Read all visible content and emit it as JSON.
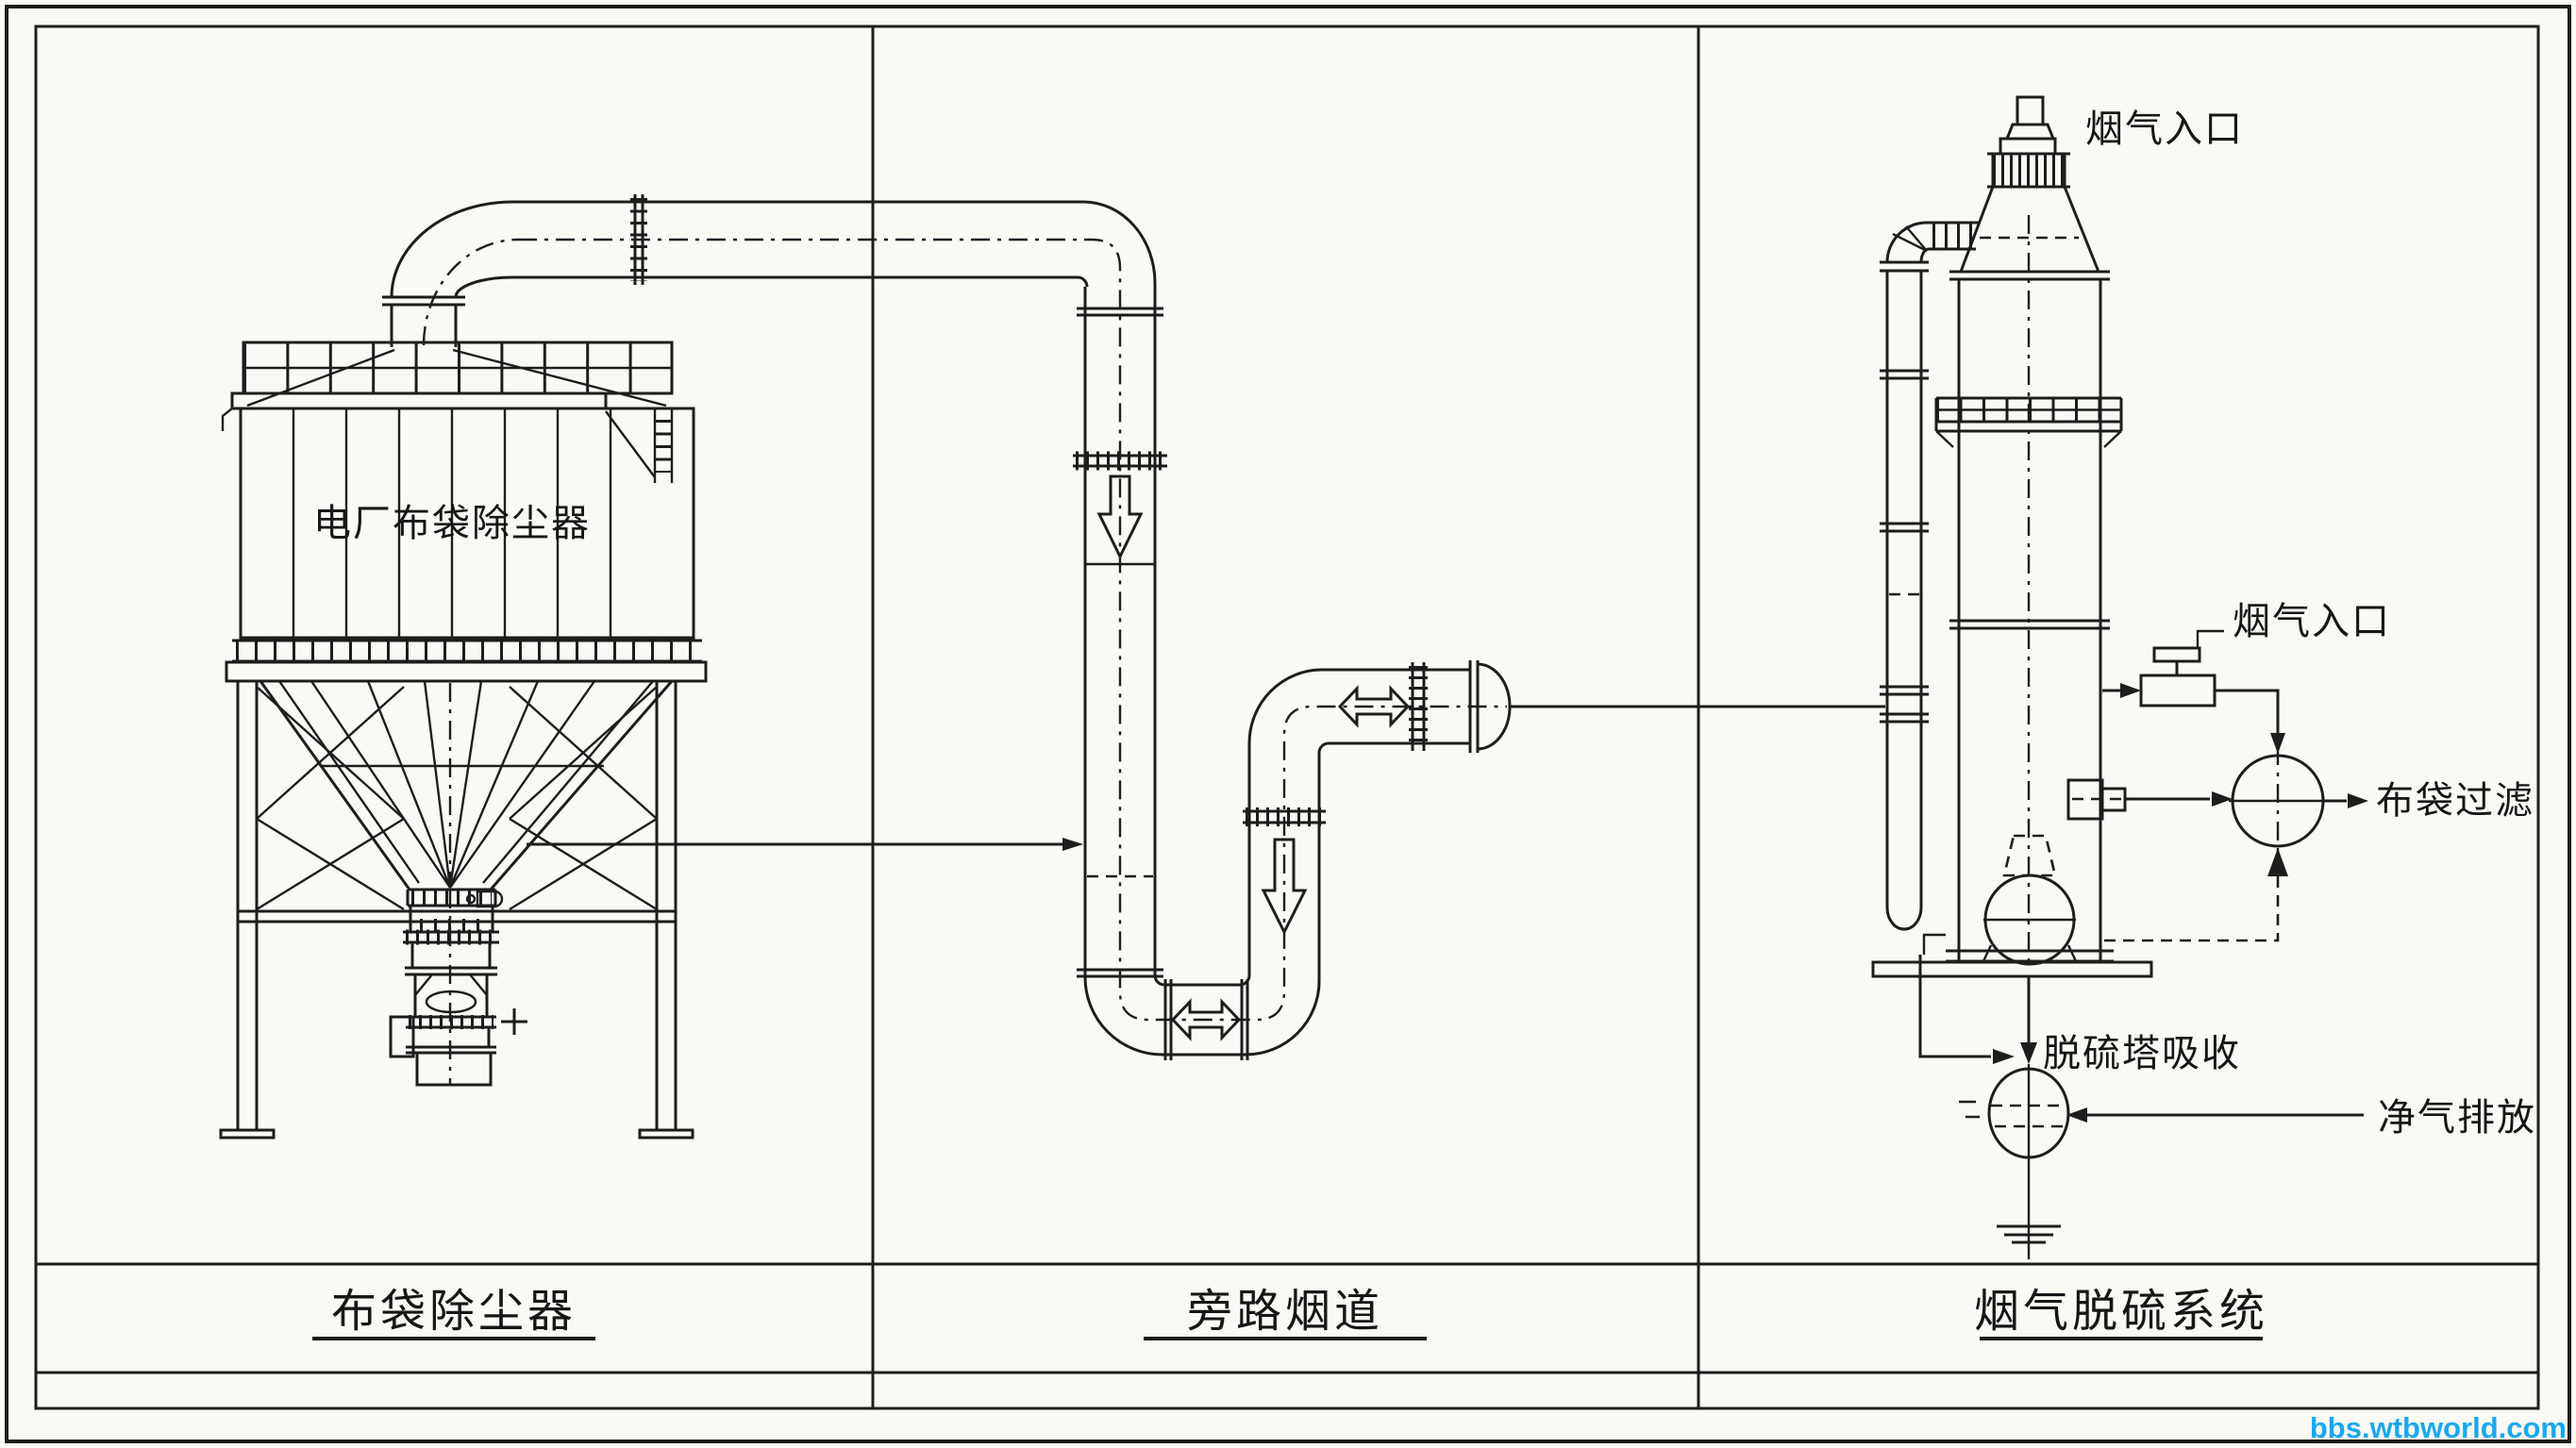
{
  "colors": {
    "ink": "#1d1d1b",
    "paper": "#fbf9f3",
    "watermark_blue": "#19a8f0"
  },
  "sections": {
    "left": {
      "title": "布袋除尘器"
    },
    "middle": {
      "title": "旁路烟道"
    },
    "right": {
      "title": "烟气脱硫系统"
    }
  },
  "annotations": {
    "baghouse_body_label": "电厂布袋除尘器",
    "tower_top_inlet_label": "烟气入口",
    "valve_inlet_label": "烟气入口",
    "bag_filter_label": "布袋过滤",
    "absorber_label": "脱硫塔吸收",
    "clean_gas_label": "净气排放"
  },
  "watermark": "bbs.wtbworld.com"
}
